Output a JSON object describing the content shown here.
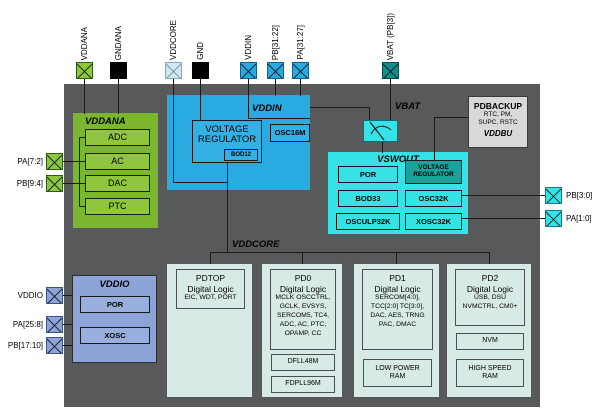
{
  "diagram_type": "MCU power-domain block diagram",
  "colors": {
    "chip_background": "#58595b",
    "analog_domain_green": "#7ab62e",
    "analog_module_green": "#8fc63e",
    "vddin_blue": "#29abe2",
    "vswout_cyan": "#35e3e6",
    "backup_regulator_teal": "#1ba39b",
    "vbat_pin_teal": "#0f8e8e",
    "vddio_periwinkle": "#8da4d8",
    "pdbackup_gray": "#d9d9d9",
    "logic_block_mint": "#d8eae6",
    "pin_black": "#000000",
    "vddcore_pin_light": "#cfe9f2"
  },
  "pins": {
    "top": [
      {
        "label": "VDDANA"
      },
      {
        "label": "GNDANA"
      },
      {
        "label": "VDDCORE"
      },
      {
        "label": "GND"
      },
      {
        "label": "VDDIN"
      },
      {
        "label": "PB[31:22]"
      },
      {
        "label": "PA[31:27]"
      },
      {
        "label": "VBAT (PB[3])"
      }
    ],
    "left": [
      {
        "label": "PA[7:2]"
      },
      {
        "label": "PB[9:4]"
      },
      {
        "label": "VDDIO"
      },
      {
        "label": "PA[25:8]"
      },
      {
        "label": "PB[17:10]"
      }
    ],
    "right": [
      {
        "label": "PB[3:0]"
      },
      {
        "label": "PA[1:0]"
      }
    ]
  },
  "vddana": {
    "label": "VDDANA",
    "modules": [
      "ADC",
      "AC",
      "DAC",
      "PTC"
    ]
  },
  "vddin": {
    "label": "VDDIN",
    "voltage_regulator": "VOLTAGE REGULATOR",
    "bod": "BOD12",
    "oscillator": "OSC16M"
  },
  "vbat": {
    "label": "VBAT"
  },
  "vswout": {
    "label": "VSWOUT",
    "modules_left": [
      "POR",
      "BOD33",
      "OSCULP32K"
    ],
    "voltage_regulator": "VOLTAGE REGULATOR",
    "modules_right": [
      "OSC32K",
      "XOSC32K"
    ]
  },
  "pdbackup": {
    "title": "PDBACKUP",
    "peripherals_line1": "RTC, PM,",
    "peripherals_line2": "SUPC, RSTC",
    "domain": "VDDBU"
  },
  "vddcore": {
    "label": "VDDCORE"
  },
  "vddio": {
    "label": "VDDIO",
    "modules": [
      "POR",
      "XOSC"
    ]
  },
  "power_domains": [
    {
      "title": "PDTOP",
      "subtitle": "Digital Logic",
      "details": "EIC, WDT, PORT",
      "sub_blocks": []
    },
    {
      "title": "PD0",
      "subtitle": "Digital Logic",
      "details": "MCLK OSCCTRL, GCLK, EVSYS, SERCOM5, TC4, ADC, AC, PTC, OPAMP, CC",
      "sub_blocks": [
        "DFLL48M",
        "FDPLL96M"
      ]
    },
    {
      "title": "PD1",
      "subtitle": "Digital Logic",
      "details": "SERCOM[4:0], TCC[2:0] TC[3:0], DAC, AES, TRNG PAC, DMAC",
      "sub_blocks": [
        "LOW POWER RAM"
      ]
    },
    {
      "title": "PD2",
      "subtitle": "Digital Logic",
      "details": "USB, DSU NVMCTRL, CM0+",
      "sub_blocks": [
        "NVM",
        "HIGH SPEED RAM"
      ]
    }
  ]
}
